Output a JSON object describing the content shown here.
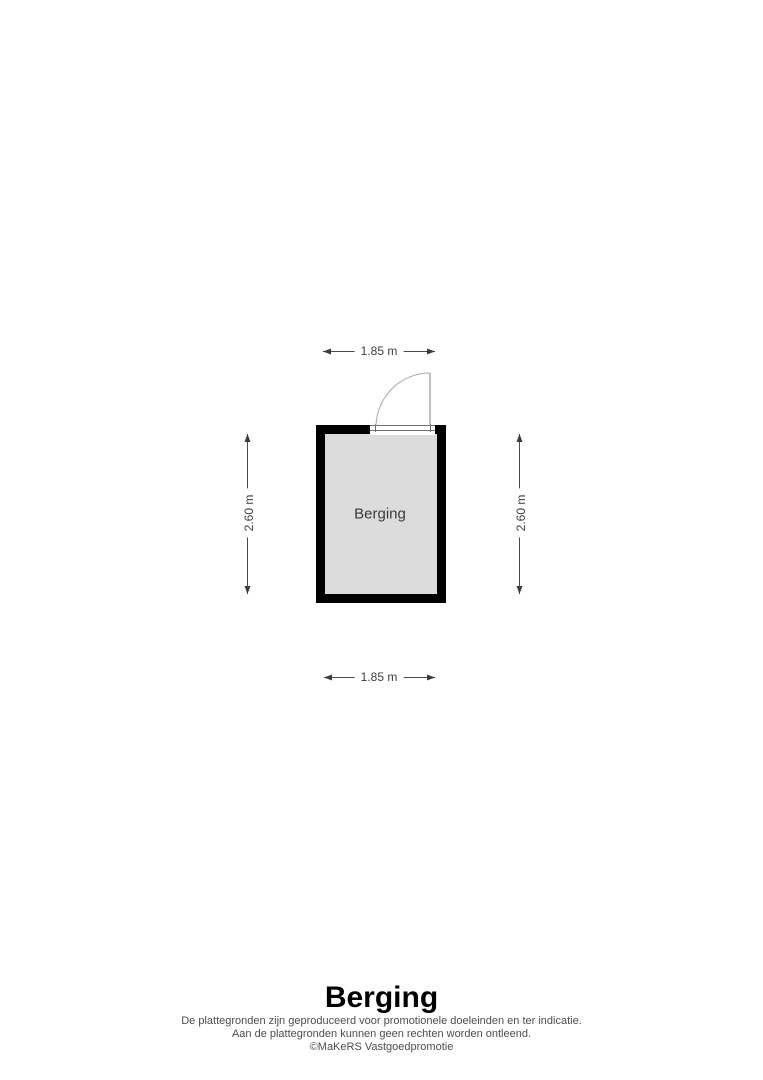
{
  "floorplan": {
    "room": {
      "label": "Berging"
    },
    "dimensions": {
      "top": "1.85 m",
      "bottom": "1.85 m",
      "left": "2.60 m",
      "right": "2.60 m"
    },
    "colors": {
      "wall": "#000000",
      "room_fill": "#dcdcdc",
      "door_line": "#9a9a9a",
      "threshold_line": "#6e6e6e",
      "dimension_line": "#4a4a4a",
      "dimension_text": "#3c3c3c",
      "disclaimer_text": "#4d4d4d"
    }
  },
  "footer": {
    "title": "Berging",
    "disclaimer_line1": "De plattegronden zijn geproduceerd voor promotionele doeleinden en ter indicatie.",
    "disclaimer_line2": "Aan de plattegronden kunnen geen rechten worden ontleend.",
    "copyright": "©MaKeRS Vastgoedpromotie"
  }
}
